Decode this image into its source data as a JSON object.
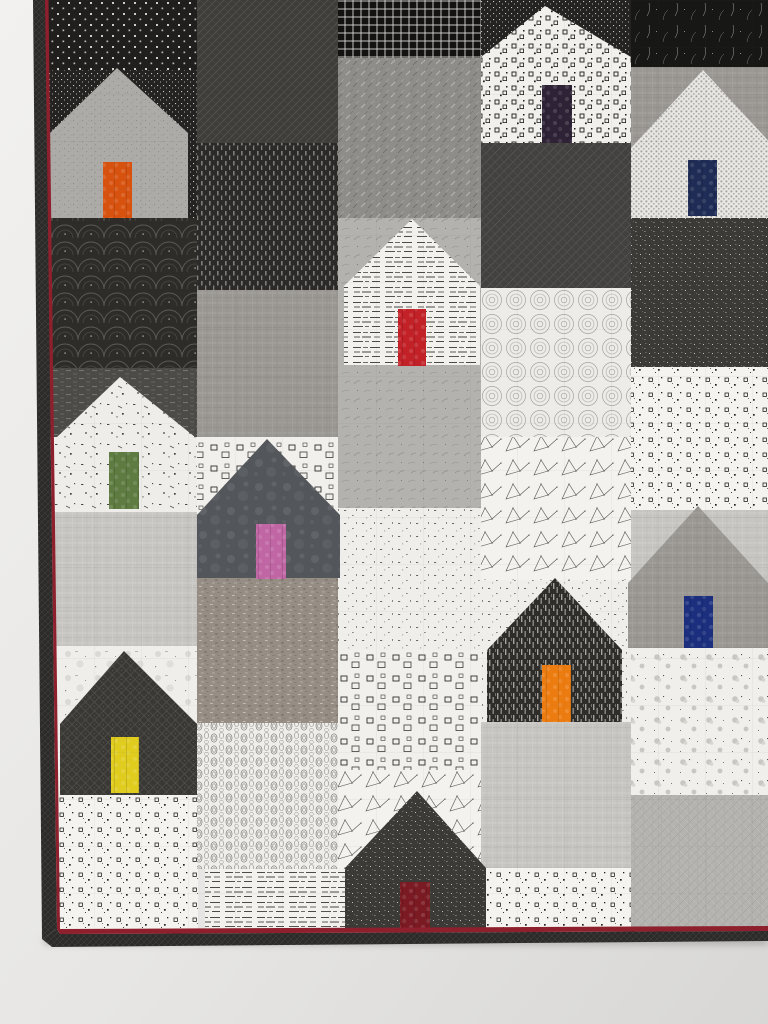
{
  "scene": {
    "description": "Photograph of a modern patchwork quilt hanging on a pale wall: staggered house blocks pieced from black, white and gray printed fabrics, each house with a brightly colored door; dark pieced binding with a thin dark-red accent line on the left and bottom edges",
    "wall": {
      "base": "#e9e8e6",
      "shade": "#d7d6d4",
      "highlight": "#f2f1ef"
    },
    "accent_red": "#8e1f2c",
    "binding": {
      "fabric": "bindingDark",
      "left_dark": [
        [
          33,
          0
        ],
        [
          45,
          0
        ],
        [
          57,
          929
        ],
        [
          42,
          939
        ]
      ],
      "left_red": [
        [
          45,
          0
        ],
        [
          48.5,
          0
        ],
        [
          60,
          929
        ],
        [
          57,
          929
        ]
      ],
      "bottom_red": [
        [
          57,
          929
        ],
        [
          768,
          926
        ],
        [
          768,
          931
        ],
        [
          60,
          934
        ]
      ],
      "bottom_dark": [
        [
          60,
          934
        ],
        [
          768,
          931
        ],
        [
          768,
          941
        ],
        [
          52,
          947
        ],
        [
          42,
          939
        ],
        [
          57,
          929
        ]
      ]
    },
    "quilt_grid_opacity": 0.55,
    "blocks": [
      [
        44,
        0,
        154,
        70,
        "dotsBig"
      ],
      [
        44,
        70,
        154,
        148,
        "dotsFine"
      ],
      [
        44,
        218,
        154,
        150,
        "fans"
      ],
      [
        44,
        368,
        154,
        69,
        "darkRows"
      ],
      [
        44,
        437,
        154,
        75,
        "grungeScribble"
      ],
      [
        44,
        512,
        154,
        134,
        "linenPale"
      ],
      [
        44,
        646,
        154,
        78,
        "grunge"
      ],
      [
        44,
        724,
        154,
        71,
        "grunge"
      ],
      [
        44,
        795,
        154,
        137,
        "speckleSq"
      ],
      [
        197,
        0,
        141,
        143,
        "crosshatchDark"
      ],
      [
        197,
        143,
        141,
        147,
        "rainDark"
      ],
      [
        197,
        290,
        141,
        147,
        "linenMid"
      ],
      [
        197,
        437,
        141,
        78,
        "sqOutlines"
      ],
      [
        197,
        578,
        143,
        145,
        "tweed"
      ],
      [
        197,
        723,
        143,
        146,
        "ovalRings"
      ],
      [
        205,
        869,
        140,
        63,
        "textPrint"
      ],
      [
        338,
        0,
        143,
        58,
        "gridBlack"
      ],
      [
        338,
        58,
        143,
        160,
        "scribbleGray"
      ],
      [
        338,
        218,
        143,
        290,
        "burstGray"
      ],
      [
        338,
        508,
        143,
        142,
        "confetti"
      ],
      [
        338,
        650,
        143,
        120,
        "sqOutlines"
      ],
      [
        338,
        770,
        143,
        99,
        "constellation"
      ],
      [
        481,
        0,
        150,
        57,
        "dotsFine"
      ],
      [
        481,
        143,
        150,
        145,
        "latticeDark"
      ],
      [
        481,
        288,
        150,
        149,
        "ovalSwirl"
      ],
      [
        481,
        437,
        150,
        143,
        "constellation"
      ],
      [
        481,
        580,
        150,
        142,
        "confetti"
      ],
      [
        481,
        722,
        150,
        146,
        "linenPale"
      ],
      [
        481,
        868,
        150,
        64,
        "speckleSq"
      ],
      [
        631,
        0,
        137,
        67,
        "scratchBlack"
      ],
      [
        631,
        67,
        137,
        81,
        "linenMid"
      ],
      [
        631,
        218,
        137,
        149,
        "pepperDark"
      ],
      [
        631,
        367,
        137,
        143,
        "speckleSq"
      ],
      [
        631,
        510,
        137,
        73,
        "linenPale"
      ],
      [
        631,
        648,
        137,
        147,
        "floral"
      ],
      [
        631,
        795,
        137,
        137,
        "meshGray"
      ]
    ],
    "houses": [
      {
        "id": "house-orange-door",
        "fabric": "grayDotted",
        "peak": [
          117,
          68
        ],
        "eave": 133,
        "body": [
          50,
          133,
          138,
          85
        ],
        "door": [
          103,
          162,
          29,
          56
        ],
        "door_color": "#d8520f"
      },
      {
        "id": "house-aubergine-door",
        "fabric": "squaresBW",
        "peak": [
          545,
          6
        ],
        "eave": 57,
        "body": [
          481,
          57,
          150,
          86
        ],
        "door": [
          542,
          85,
          30,
          58
        ],
        "door_color": "#2e2336"
      },
      {
        "id": "house-navy-door-top",
        "fabric": "checkTiny",
        "peak": [
          703,
          70
        ],
        "eave": 148,
        "body": [
          631,
          148,
          137,
          70
        ],
        "roof_right": 775,
        "door": [
          688,
          160,
          29,
          56
        ],
        "door_color": "#1f2c56"
      },
      {
        "id": "house-red-door",
        "fabric": "textPrint",
        "peak": [
          412,
          219
        ],
        "eave": 286,
        "body": [
          344,
          286,
          136,
          79
        ],
        "door": [
          398,
          309,
          28,
          57
        ],
        "door_color": "#c32128"
      },
      {
        "id": "house-pink-door",
        "fabric": "slateMottle",
        "peak": [
          267,
          439
        ],
        "eave": 515,
        "body": [
          197,
          515,
          143,
          63
        ],
        "door": [
          256,
          524,
          30,
          55
        ],
        "door_color": "#c166a4"
      },
      {
        "id": "house-green-door",
        "fabric": "grungeScribble",
        "peak": [
          120,
          377
        ],
        "eave": 437,
        "body": [
          57,
          437,
          138,
          75
        ],
        "door": [
          109,
          452,
          30,
          57
        ],
        "door_color": "#5e7b41"
      },
      {
        "id": "house-yellow-door",
        "fabric": "diamondDark",
        "peak": [
          124,
          651
        ],
        "eave": 724,
        "body": [
          60,
          724,
          137,
          71
        ],
        "door": [
          111,
          737,
          28,
          56
        ],
        "door_color": "#e0cc1e"
      },
      {
        "id": "house-orange-door-dark",
        "fabric": "stripeDark",
        "peak": [
          555,
          578
        ],
        "eave": 650,
        "body": [
          487,
          650,
          135,
          72
        ],
        "door": [
          542,
          665,
          29,
          57
        ],
        "door_color": "#ed7c10"
      },
      {
        "id": "house-royal-navy-door",
        "fabric": "linenMid",
        "peak": [
          698,
          506
        ],
        "eave": 583,
        "body": [
          628,
          583,
          140,
          65
        ],
        "door": [
          684,
          596,
          29,
          52
        ],
        "door_color": "#1b2f7e"
      },
      {
        "id": "house-maroon-door",
        "fabric": "pepperDark",
        "peak": [
          417,
          791
        ],
        "eave": 868,
        "body": [
          345,
          868,
          141,
          64
        ],
        "door": [
          400,
          882,
          30,
          50
        ],
        "door_color": "#7b1a23"
      }
    ]
  }
}
